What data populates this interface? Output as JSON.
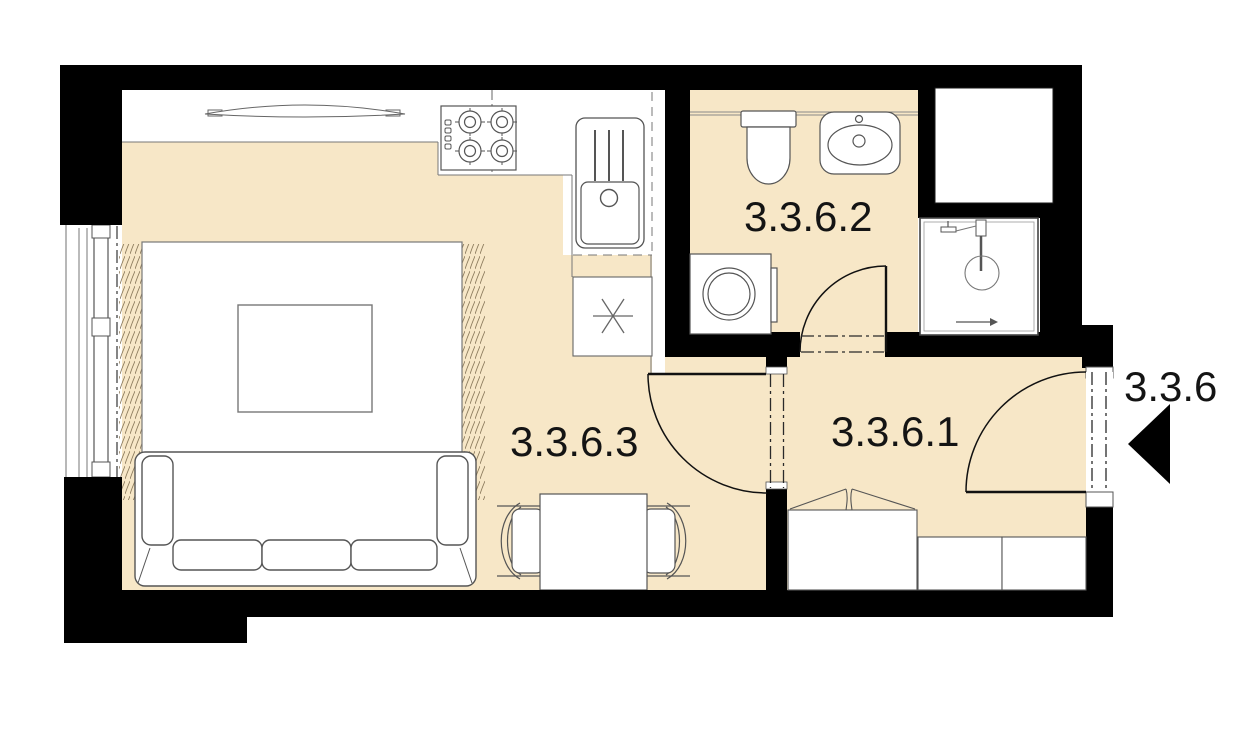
{
  "plan": {
    "unit_label": "3.3.6",
    "entry_direction": "left",
    "rooms": [
      {
        "id": "hallway",
        "label": "3.3.6.1"
      },
      {
        "id": "bathroom",
        "label": "3.3.6.2"
      },
      {
        "id": "living-kitchen",
        "label": "3.3.6.3"
      }
    ],
    "colors": {
      "floor": "#f7e7c7",
      "wall": "#000000",
      "outline": "#5f5f5f",
      "background": "#ffffff",
      "label": "#141414",
      "fringe": "#8d7c5e"
    },
    "fixtures": [
      "window",
      "curtain",
      "rug",
      "coffee-table",
      "sofa",
      "tv",
      "cooktop",
      "kitchen-sink",
      "refrigerator",
      "toilet",
      "washbasin",
      "washing-machine",
      "shower",
      "dining-table",
      "chair-left",
      "chair-right",
      "wardrobe",
      "cabinet",
      "interior-door",
      "bathroom-door",
      "entry-door",
      "entry-arrow",
      "duct-shaft"
    ]
  }
}
